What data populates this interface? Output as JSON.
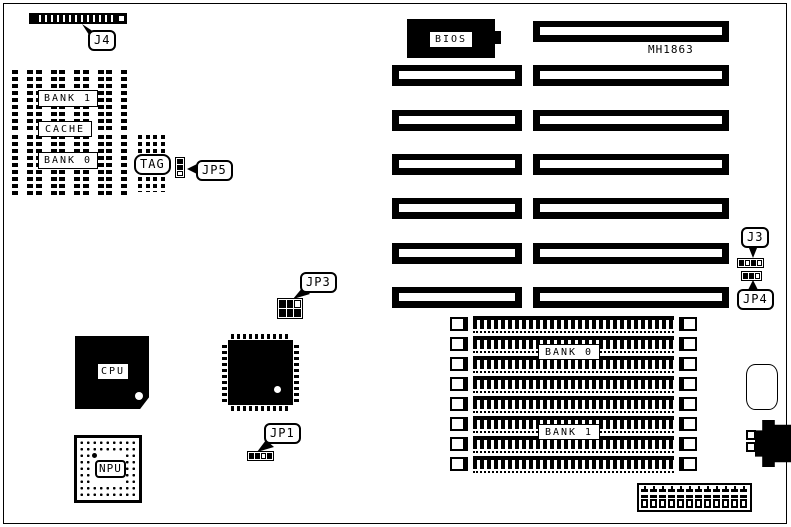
{
  "part_number": "MH1863",
  "colors": {
    "board_background": "#ffffff",
    "ink": "#000000"
  },
  "callouts": {
    "j4": "J4",
    "jp5": "JP5",
    "jp3": "JP3",
    "jp1": "JP1",
    "j3": "J3",
    "jp4": "JP4"
  },
  "cache_area": {
    "bank1_label": "BANK 1",
    "cache_label": "CACHE",
    "bank0_label": "BANK 0",
    "tag_label": "TAG",
    "rows": 2,
    "chips_per_row": 5,
    "tag_chip_count": 2
  },
  "chips": {
    "bios_label": "BIOS",
    "cpu_label": "CPU",
    "npu_label": "NPU"
  },
  "expansion_slots": {
    "right_column_count": 7,
    "left_column_count": 6
  },
  "memory": {
    "socket_count": 8,
    "bank0_label": "BANK 0",
    "bank1_label": "BANK 1"
  },
  "power_connector": {
    "pin_count": 12
  }
}
